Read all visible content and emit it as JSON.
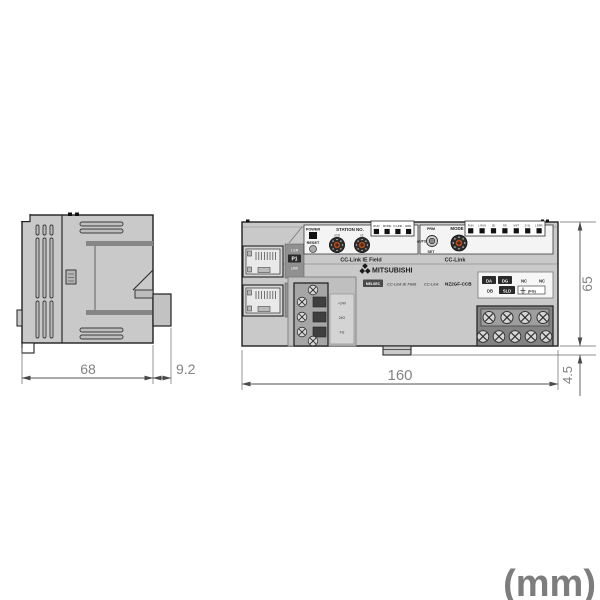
{
  "unit_label": "(mm)",
  "dimensions": {
    "side_width": "68",
    "side_depth": "9.2",
    "front_width": "160",
    "front_height": "65",
    "din_offset": "4.5"
  },
  "front_view": {
    "top_left_panel": {
      "power_label": "POWER",
      "reset_label": "RESET",
      "station_no_label": "STATION NO.",
      "x10_label": "x10",
      "x1_label": "x1",
      "led_labels": [
        "RUN",
        "MODE",
        "D LINK",
        "ERR."
      ],
      "caption": "CC-Link IE Field"
    },
    "top_right_panel": {
      "prm_label": "PRM",
      "auto_label": "AUTO",
      "set_label": "SET",
      "mode_label": "MODE",
      "led_labels": [
        "RUN",
        "L RUN",
        "SD",
        "RD",
        "MST",
        "D SL",
        "L ERR."
      ],
      "caption": "CC-Link"
    },
    "branding": {
      "brand": "MITSUBISHI",
      "series_badge": "MELSEC",
      "network_logo_1": "CC-Link IE Field",
      "network_logo_2": "CC-Link",
      "model": "NZ2GF-CCB"
    },
    "ports": {
      "p1_label": "P1",
      "p2_label": "P2",
      "l_er_label": "L ER",
      "link_label": "LINK"
    },
    "power_terminal": {
      "labels": [
        "+24V",
        "24G",
        "FG"
      ]
    },
    "terminal_labels": {
      "row1": [
        "DA",
        "DG",
        "NC",
        "NC"
      ],
      "row2": [
        "DB",
        "SLD",
        "(FG)"
      ]
    }
  },
  "colors": {
    "module_body": "#c9c9c9",
    "panel": "#f4f4f4",
    "outline": "#1f1f1f",
    "led": "#111111",
    "rotary_center": "#a9542c",
    "dimension_text": "#838383",
    "unit_text": "#7d7d7d"
  }
}
